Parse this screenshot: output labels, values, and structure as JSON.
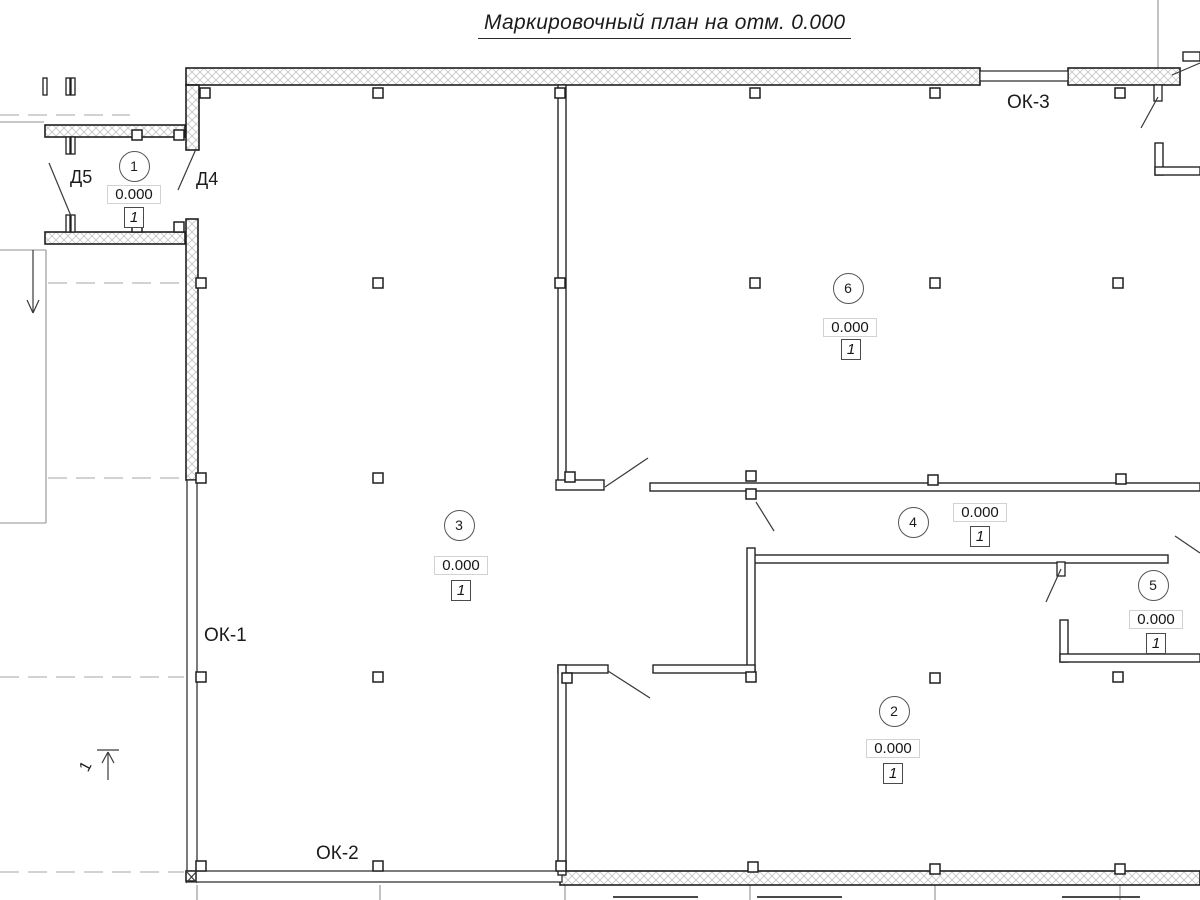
{
  "title": "Маркировочный план на отм. 0.000",
  "labels": {
    "ok1": "ОК-1",
    "ok2": "ОК-2",
    "ok3": "ОК-3",
    "d4": "Д4",
    "d5": "Д5",
    "section": "1"
  },
  "colors": {
    "line": "#1f1f1f",
    "thin_wall": "#242424",
    "hatch": "#c6c6c6",
    "aux": "#919191",
    "dashed": "#a6a6a6",
    "leader": "#3a3a3a",
    "cutoff": "#4a4a4a"
  },
  "rooms": [
    {
      "number": "1",
      "elevation": "0.000",
      "type": "1",
      "circle": [
        134,
        166
      ],
      "elev_pos": [
        134,
        194
      ],
      "type_pos": [
        134,
        217
      ]
    },
    {
      "number": "2",
      "elevation": "0.000",
      "type": "1",
      "circle": [
        894,
        711
      ],
      "elev_pos": [
        893,
        748
      ],
      "type_pos": [
        893,
        773
      ]
    },
    {
      "number": "3",
      "elevation": "0.000",
      "type": "1",
      "circle": [
        459,
        525
      ],
      "elev_pos": [
        461,
        565
      ],
      "type_pos": [
        461,
        590
      ]
    },
    {
      "number": "4",
      "elevation": "0.000",
      "type": "1",
      "circle": [
        913,
        522
      ],
      "elev_pos": [
        980,
        512
      ],
      "type_pos": [
        980,
        536
      ]
    },
    {
      "number": "5",
      "elevation": "0.000",
      "type": "1",
      "circle": [
        1153,
        585
      ],
      "elev_pos": [
        1156,
        619
      ],
      "type_pos": [
        1156,
        643
      ]
    },
    {
      "number": "6",
      "elevation": "0.000",
      "type": "1",
      "circle": [
        848,
        288
      ],
      "elev_pos": [
        850,
        327
      ],
      "type_pos": [
        851,
        349
      ]
    }
  ],
  "label_positions": {
    "ok1": [
      204,
      625
    ],
    "ok2": [
      316,
      843
    ],
    "ok3": [
      1007,
      92
    ],
    "d5": [
      70,
      167
    ],
    "d4": [
      196,
      169
    ],
    "section": [
      82,
      758
    ]
  },
  "geometry": {
    "hatched_walls": [
      [
        186,
        68,
        794,
        17
      ],
      [
        1068,
        68,
        112,
        17
      ],
      [
        186,
        85,
        13,
        65
      ],
      [
        186,
        219,
        12,
        261
      ],
      [
        45,
        125,
        140,
        12
      ],
      [
        45,
        232,
        140,
        12
      ],
      [
        560,
        871,
        640,
        14
      ]
    ],
    "thin_walls": [
      [
        558,
        85,
        8,
        400
      ],
      [
        556,
        480,
        48,
        10
      ],
      [
        650,
        483,
        550,
        8
      ],
      [
        754,
        555,
        414,
        8
      ],
      [
        747,
        548,
        8,
        124
      ],
      [
        653,
        665,
        102,
        8
      ],
      [
        558,
        665,
        50,
        8
      ],
      [
        558,
        665,
        8,
        210
      ],
      [
        1060,
        620,
        8,
        42
      ],
      [
        1060,
        654,
        140,
        8
      ],
      [
        1155,
        143,
        8,
        32
      ],
      [
        1155,
        167,
        45,
        8
      ],
      [
        1183,
        52,
        17,
        9
      ]
    ],
    "windows": [
      [
        980,
        71,
        88,
        10
      ],
      [
        187,
        480,
        10,
        395
      ],
      [
        186,
        871,
        376,
        11
      ]
    ],
    "markers": [
      [
        200,
        88
      ],
      [
        373,
        88
      ],
      [
        555,
        88
      ],
      [
        750,
        88
      ],
      [
        930,
        88
      ],
      [
        1115,
        88
      ],
      [
        196,
        278
      ],
      [
        373,
        278
      ],
      [
        555,
        278
      ],
      [
        750,
        278
      ],
      [
        930,
        278
      ],
      [
        1113,
        278
      ],
      [
        196,
        473
      ],
      [
        373,
        473
      ],
      [
        565,
        472
      ],
      [
        746,
        471
      ],
      [
        746,
        489
      ],
      [
        928,
        475
      ],
      [
        1116,
        474
      ],
      [
        196,
        672
      ],
      [
        373,
        672
      ],
      [
        562,
        673
      ],
      [
        746,
        672
      ],
      [
        930,
        673
      ],
      [
        1113,
        672
      ],
      [
        196,
        861
      ],
      [
        373,
        861
      ],
      [
        556,
        861
      ],
      [
        748,
        862
      ],
      [
        930,
        864
      ],
      [
        1115,
        864
      ],
      [
        132,
        130
      ],
      [
        174,
        130
      ],
      [
        132,
        222
      ],
      [
        174,
        222
      ],
      [
        186,
        871
      ]
    ],
    "jambs": [
      [
        66,
        137,
        4,
        17
      ],
      [
        71,
        137,
        4,
        17
      ],
      [
        66,
        215,
        4,
        17
      ],
      [
        71,
        215,
        4,
        17
      ],
      [
        43,
        78,
        4,
        17
      ],
      [
        66,
        78,
        4,
        17
      ],
      [
        71,
        78,
        4,
        17
      ],
      [
        1154,
        85,
        8,
        16
      ],
      [
        1057,
        562,
        8,
        14
      ]
    ],
    "leader_lines": [
      [
        49,
        163,
        71,
        216
      ],
      [
        178,
        190,
        196,
        149
      ],
      [
        605,
        487,
        648,
        458
      ],
      [
        608,
        671,
        650,
        698
      ],
      [
        756,
        502,
        774,
        531
      ],
      [
        1046,
        602,
        1061,
        569
      ],
      [
        1141,
        128,
        1158,
        97
      ],
      [
        1172,
        75,
        1200,
        63
      ],
      [
        1175,
        536,
        1200,
        553
      ],
      [
        33,
        250,
        33,
        313
      ],
      [
        27,
        300,
        33,
        313
      ],
      [
        39,
        300,
        33,
        313
      ],
      [
        108,
        780,
        108,
        753
      ],
      [
        97,
        750,
        119,
        750
      ],
      [
        108,
        752,
        102,
        763
      ],
      [
        108,
        752,
        114,
        763
      ],
      [
        186,
        871,
        197,
        883
      ],
      [
        186,
        883,
        197,
        871
      ]
    ],
    "aux_lines": [
      [
        0,
        250,
        46,
        250
      ],
      [
        46,
        250,
        46,
        523
      ],
      [
        0,
        523,
        46,
        523
      ],
      [
        0,
        122,
        44,
        122
      ],
      [
        197,
        885,
        197,
        900
      ],
      [
        380,
        885,
        380,
        900
      ],
      [
        565,
        885,
        565,
        900
      ],
      [
        750,
        885,
        750,
        900
      ],
      [
        935,
        885,
        935,
        900
      ],
      [
        1120,
        885,
        1120,
        900
      ],
      [
        1158,
        0,
        1158,
        68
      ]
    ],
    "dashed_lines": [
      [
        0,
        115,
        130,
        115
      ],
      [
        48,
        283,
        184,
        283
      ],
      [
        48,
        478,
        184,
        478
      ],
      [
        0,
        677,
        184,
        677
      ],
      [
        0,
        872,
        184,
        872
      ]
    ],
    "cutoff_segments": [
      [
        613,
        897,
        698,
        897
      ],
      [
        757,
        897,
        842,
        897
      ],
      [
        1062,
        897,
        1140,
        897
      ]
    ]
  }
}
